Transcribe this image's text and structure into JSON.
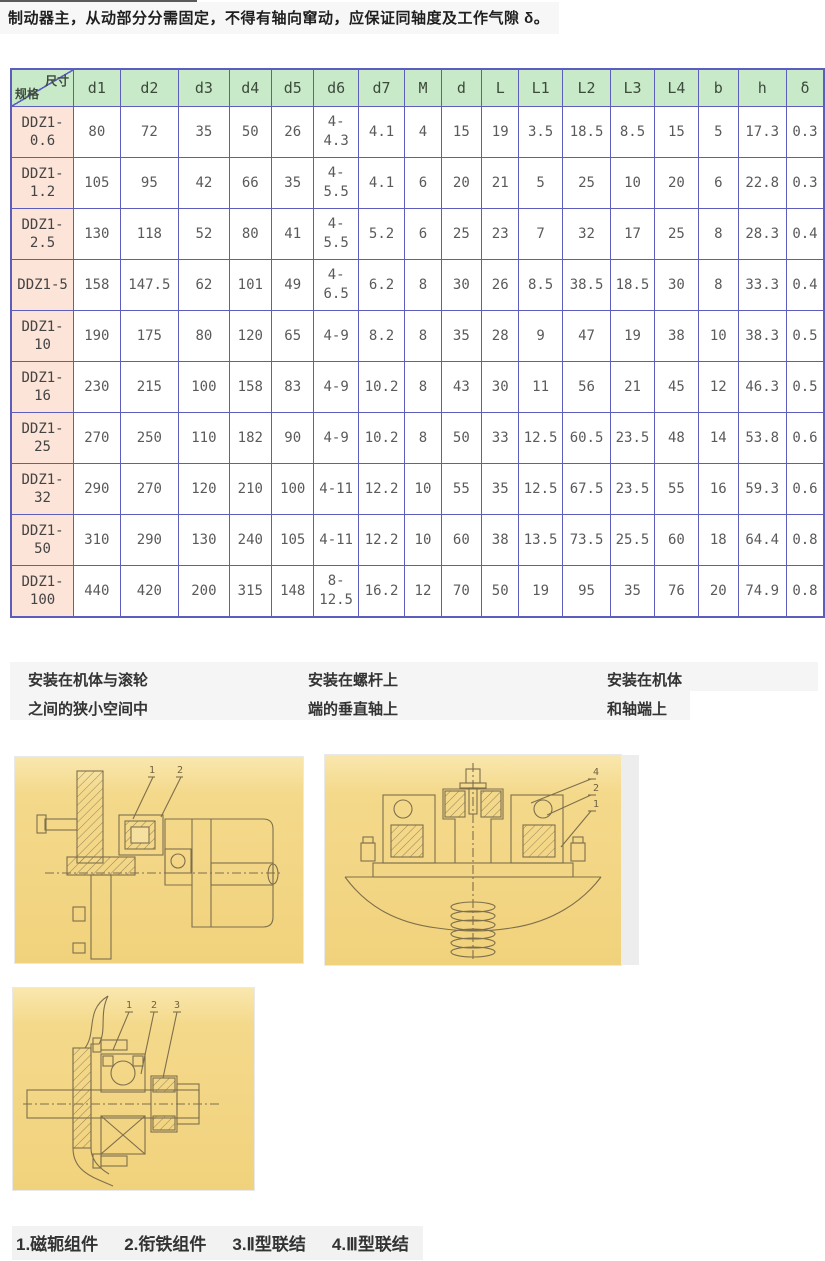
{
  "intro": {
    "text": "制动器主，从动部分分需固定，不得有轴向窜动，应保证同轴度及工作气隙 δ。"
  },
  "table": {
    "corner": {
      "top_right": "尺寸",
      "bottom_left": "规格"
    },
    "columns": [
      "d1",
      "d2",
      "d3",
      "d4",
      "d5",
      "d6",
      "d7",
      "M",
      "d",
      "L",
      "L1",
      "L2",
      "L3",
      "L4",
      "b",
      "h",
      "δ"
    ],
    "rows": [
      {
        "spec": "DDZ1-0.6",
        "values": [
          "80",
          "72",
          "35",
          "50",
          "26",
          "4-4.3",
          "4.1",
          "4",
          "15",
          "19",
          "3.5",
          "18.5",
          "8.5",
          "15",
          "5",
          "17.3",
          "0.3"
        ]
      },
      {
        "spec": "DDZ1-1.2",
        "values": [
          "105",
          "95",
          "42",
          "66",
          "35",
          "4-5.5",
          "4.1",
          "6",
          "20",
          "21",
          "5",
          "25",
          "10",
          "20",
          "6",
          "22.8",
          "0.3"
        ]
      },
      {
        "spec": "DDZ1-2.5",
        "values": [
          "130",
          "118",
          "52",
          "80",
          "41",
          "4-5.5",
          "5.2",
          "6",
          "25",
          "23",
          "7",
          "32",
          "17",
          "25",
          "8",
          "28.3",
          "0.4"
        ]
      },
      {
        "spec": "DDZ1-5",
        "values": [
          "158",
          "147.5",
          "62",
          "101",
          "49",
          "4-6.5",
          "6.2",
          "8",
          "30",
          "26",
          "8.5",
          "38.5",
          "18.5",
          "30",
          "8",
          "33.3",
          "0.4"
        ]
      },
      {
        "spec": "DDZ1-10",
        "values": [
          "190",
          "175",
          "80",
          "120",
          "65",
          "4-9",
          "8.2",
          "8",
          "35",
          "28",
          "9",
          "47",
          "19",
          "38",
          "10",
          "38.3",
          "0.5"
        ]
      },
      {
        "spec": "DDZ1-16",
        "values": [
          "230",
          "215",
          "100",
          "158",
          "83",
          "4-9",
          "10.2",
          "8",
          "43",
          "30",
          "11",
          "56",
          "21",
          "45",
          "12",
          "46.3",
          "0.5"
        ]
      },
      {
        "spec": "DDZ1-25",
        "values": [
          "270",
          "250",
          "110",
          "182",
          "90",
          "4-9",
          "10.2",
          "8",
          "50",
          "33",
          "12.5",
          "60.5",
          "23.5",
          "48",
          "14",
          "53.8",
          "0.6"
        ]
      },
      {
        "spec": "DDZ1-32",
        "values": [
          "290",
          "270",
          "120",
          "210",
          "100",
          "4-11",
          "12.2",
          "10",
          "55",
          "35",
          "12.5",
          "67.5",
          "23.5",
          "55",
          "16",
          "59.3",
          "0.6"
        ]
      },
      {
        "spec": "DDZ1-50",
        "values": [
          "310",
          "290",
          "130",
          "240",
          "105",
          "4-11",
          "12.2",
          "10",
          "60",
          "38",
          "13.5",
          "73.5",
          "25.5",
          "60",
          "18",
          "64.4",
          "0.8"
        ]
      },
      {
        "spec": "DDZ1-100",
        "values": [
          "440",
          "420",
          "200",
          "315",
          "148",
          "8-12.5",
          "16.2",
          "12",
          "70",
          "50",
          "19",
          "95",
          "35",
          "76",
          "20",
          "74.9",
          "0.8"
        ]
      }
    ]
  },
  "captions": [
    {
      "line1": "安装在机体与滚轮",
      "line2": "之间的狭小空间中"
    },
    {
      "line1": "安装在螺杆上",
      "line2": "端的垂直轴上"
    },
    {
      "line1": "安装在机体",
      "line2": "和轴端上"
    }
  ],
  "figures": [
    {
      "name": "installed-between-housing-and-roller",
      "labels": [
        "1",
        "2"
      ]
    },
    {
      "name": "installed-on-vertical-screw-shaft-end",
      "labels": [
        "4",
        "2",
        "1"
      ]
    },
    {
      "name": "installed-on-housing-and-shaft-end",
      "labels": [
        "1",
        "2",
        "3"
      ]
    }
  ],
  "legend": {
    "items": [
      "1.磁轭组件",
      "2.衔铁组件",
      "3.Ⅱ型联结",
      "4.Ⅲ型联结"
    ]
  },
  "colors": {
    "table_border": "#5d5dbe",
    "header_green": "#c9eac9",
    "spec_pink": "#fce4d8",
    "caption_gray": "#f5f5f5",
    "drawing_yellow": "#f3d685",
    "drawing_line": "#7d6f4c"
  }
}
